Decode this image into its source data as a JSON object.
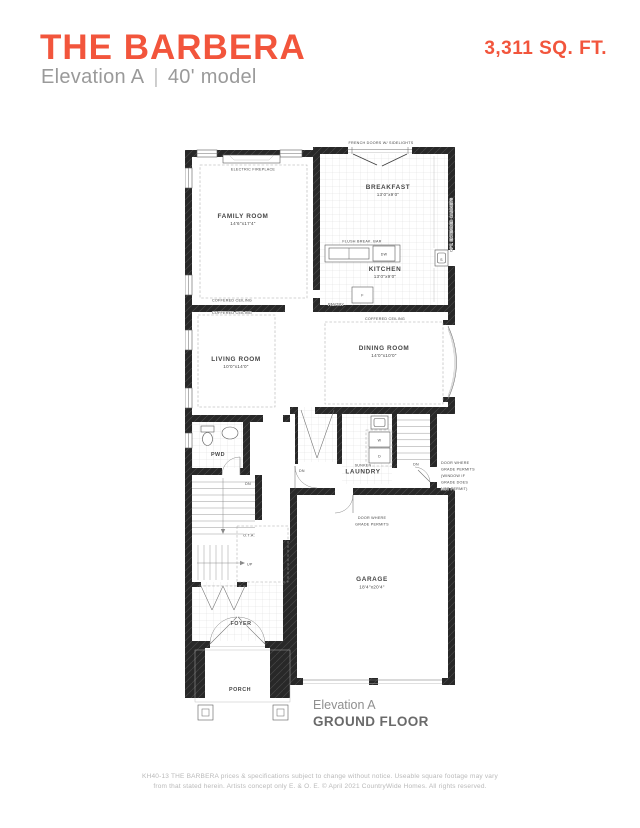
{
  "header": {
    "title": "THE BARBERA",
    "elevation": "Elevation A",
    "divider": "|",
    "model": "40' model",
    "sqft": "3,311 SQ. FT.",
    "accent_color": "#F2553C"
  },
  "plan": {
    "french_doors_note": "FRENCH DOORS W/ SIDELIGHTS",
    "electric_fireplace": "ELECTRIC FIREPLACE",
    "opt_extended_cabinets": "OPT. EXTENDED CABINETS",
    "flush_break_bar": "FLUSH BREAK. BAR",
    "pantry": "PANTRY",
    "coffered_family": "COFFERED CEILING",
    "coffered_living": "COFFERED CEILING",
    "coffered_dining": "COFFERED CEILING",
    "rooms": {
      "family": {
        "name": "FAMILY ROOM",
        "dims": "14'6\"x17'4\""
      },
      "breakfast": {
        "name": "BREAKFAST",
        "dims": "13'0\"x9'0\""
      },
      "kitchen": {
        "name": "KITCHEN",
        "dims": "13'0\"x9'0\""
      },
      "living": {
        "name": "LIVING ROOM",
        "dims": "10'0\"x14'0\""
      },
      "dining": {
        "name": "DINING ROOM",
        "dims": "14'0\"x10'0\""
      },
      "pwd": {
        "name": "PWD"
      },
      "laundry": {
        "name": "LAUNDRY",
        "prefix": "SUNKEN"
      },
      "garage": {
        "name": "GARAGE",
        "dims": "18'4\"x20'4\""
      },
      "foyer": {
        "name": "FOYER"
      },
      "porch": {
        "name": "PORCH"
      }
    },
    "appliances": {
      "dw": "DW",
      "fridge": "F",
      "sink": "S",
      "washer": "W",
      "dryer": "D"
    },
    "stairs": {
      "dn_main": "DN",
      "dn_hall": "DN",
      "dn_garage": "DN",
      "up": "UP",
      "ota": "O.T.A."
    },
    "door_note_right": [
      "DOOR WHERE",
      "GRADE PERMITS",
      "(WINDOW IF",
      "GRADE DOES",
      "NOT PERMIT)"
    ],
    "door_note_bottom": [
      "DOOR WHERE",
      "GRADE PERMITS"
    ]
  },
  "caption": {
    "elevation": "Elevation A",
    "floor": "GROUND FLOOR"
  },
  "footer": {
    "line1": "KH40-13 THE BARBERA prices & specifications subject to change without notice. Useable square footage may vary",
    "line2": "from that stated herein. Artists concept only E. & O. E. © April 2021 CountryWide Homes. All rights reserved."
  }
}
